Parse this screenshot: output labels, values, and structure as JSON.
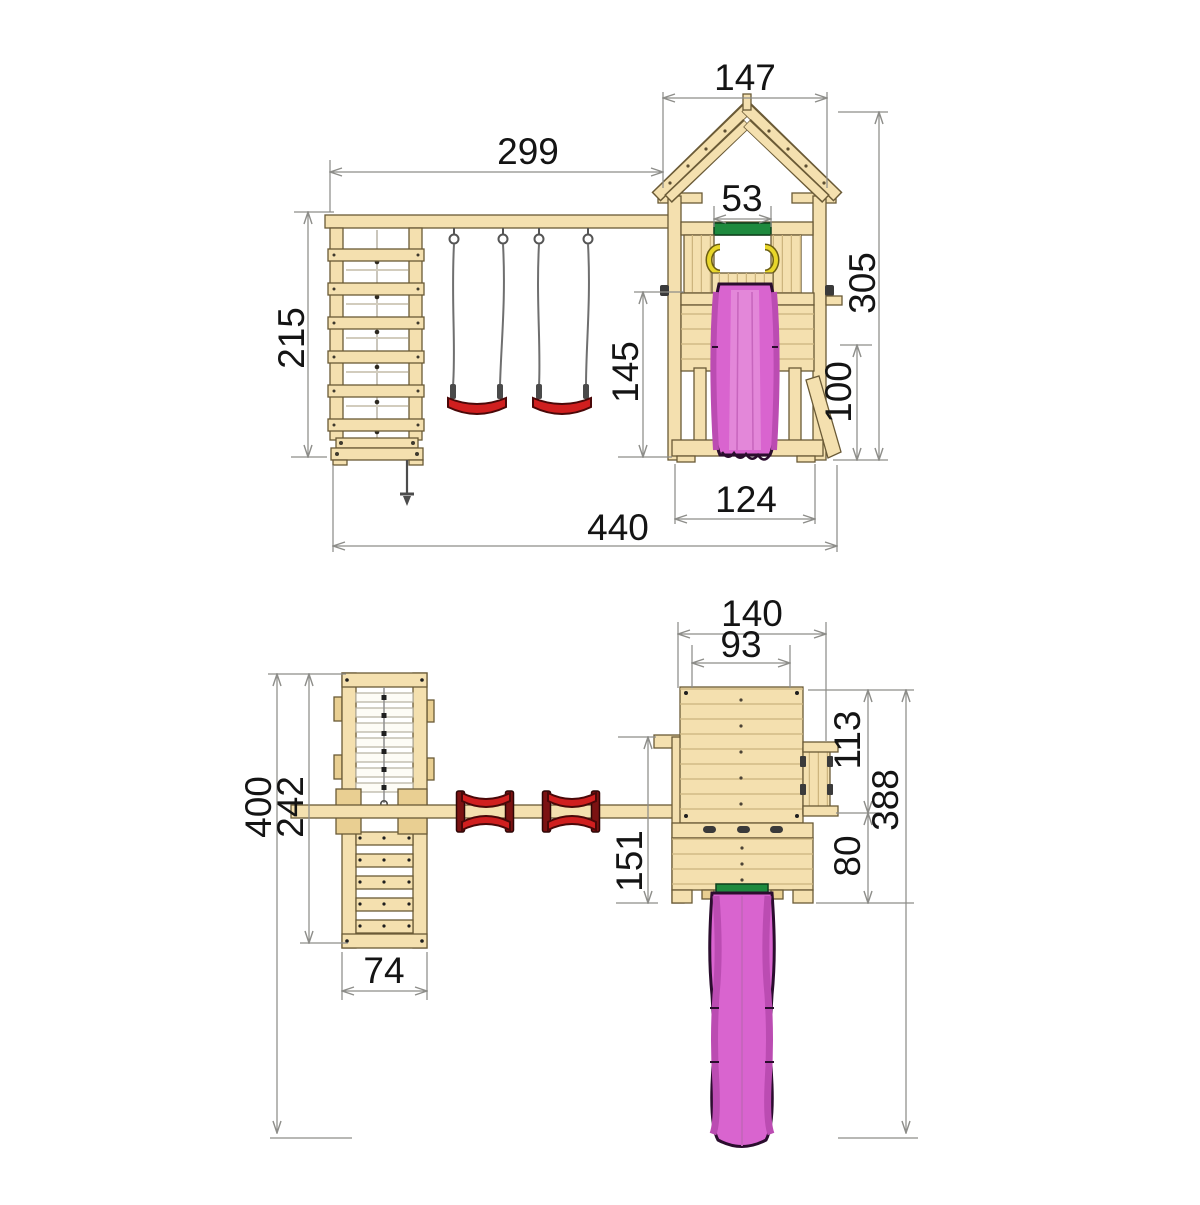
{
  "colors": {
    "wood": "#f4e0af",
    "wood_shade": "#e9cf92",
    "outline_brown": "#6a5a36",
    "dimension_line_gray": "#8d8d89",
    "dimension_text": "#141414",
    "slide_pink": "#d964cf",
    "slide_pink_dark": "#bb4cb2",
    "swing_seat_red": "#d01f1f",
    "doorway_bar_green": "#1e8a3e",
    "handle_yellow": "#e8d62a"
  },
  "front_view": {
    "dimensions": {
      "roof_width": "147",
      "beam_span": "299",
      "doorway_bar_width": "53",
      "total_height": "305",
      "climbing_frame_height": "215",
      "platform_height": "145",
      "brace_height": "100",
      "tower_base_width": "124",
      "total_width": "440"
    }
  },
  "plan_view": {
    "dimensions": {
      "tower_width": "140",
      "platform_inner_width": "93",
      "tower_upper_depth": "113",
      "depth_with_slide": "388",
      "total_depth": "400",
      "climbing_frame_depth": "242",
      "beam_to_front_depth": "151",
      "porch_depth": "80",
      "climbing_frame_width": "74"
    }
  }
}
